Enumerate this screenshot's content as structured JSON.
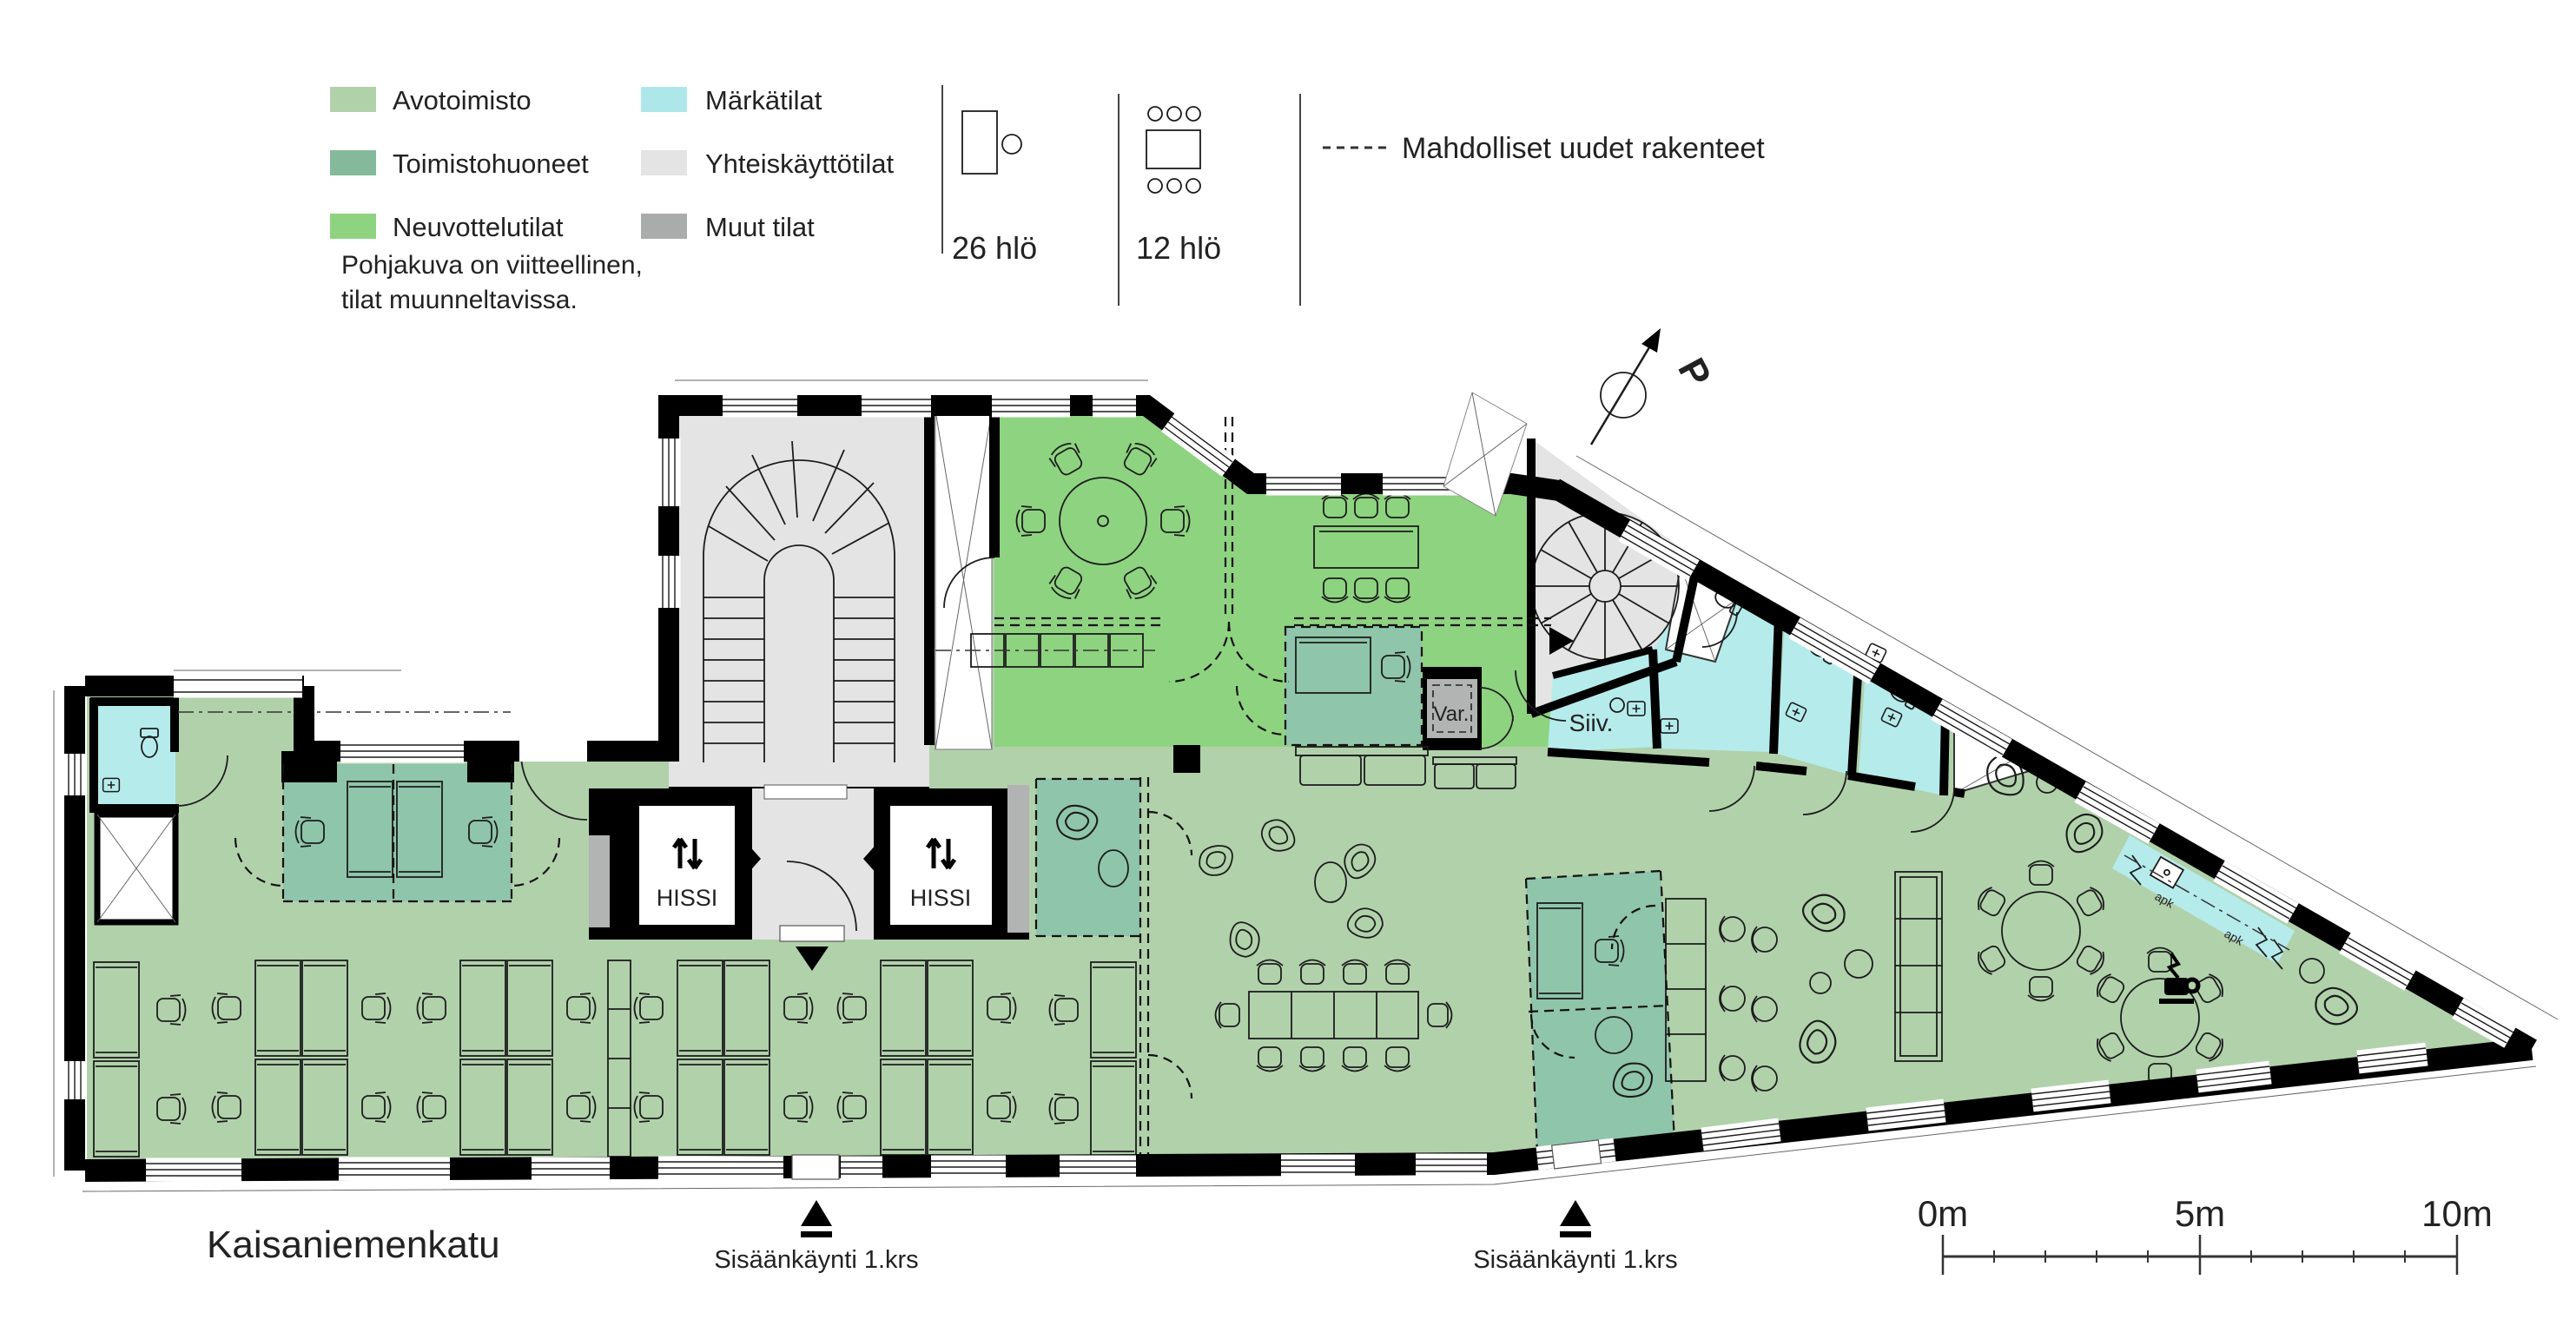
{
  "legend": {
    "items": [
      {
        "label": "Avotoimisto",
        "color": "#b1d1ab"
      },
      {
        "label": "Toimistohuoneet",
        "color": "#84b99c"
      },
      {
        "label": "Neuvottelutilat",
        "color": "#8ed380"
      },
      {
        "label": "Märkätilat",
        "color": "#aee7e9"
      },
      {
        "label": "Yhteiskäyttötilat",
        "color": "#e3e4e3"
      },
      {
        "label": "Muut tilat",
        "color": "#aaabab"
      }
    ],
    "capacity_open_office": "26 hlö",
    "capacity_meeting": "12 hlö",
    "dashed_note": "Mahdolliset uudet rakenteet"
  },
  "note": {
    "line1": "Pohjakuva on viitteellinen,",
    "line2": "tilat muunneltavissa."
  },
  "plan_labels": {
    "north": "P",
    "elevator": "HISSI",
    "storage": "Var.",
    "cleaning": "Siiv.",
    "dishwasher": "apk"
  },
  "street_label": "Kaisaniemenkatu",
  "entrance_label": "Sisäänkäynti 1.krs",
  "scale_bar": {
    "start": "0m",
    "middle": "5m",
    "end": "10m"
  },
  "icons": {
    "north_arrow": "circle-with-compass-arrow",
    "entrance_marker": "solid-triangle-up",
    "elevator_arrows": "↑↓",
    "coffee": "coffee-cup",
    "capacity_desk": "desk-with-chair",
    "capacity_table": "table-with-six-chairs",
    "new_structures": "dashed-line"
  }
}
